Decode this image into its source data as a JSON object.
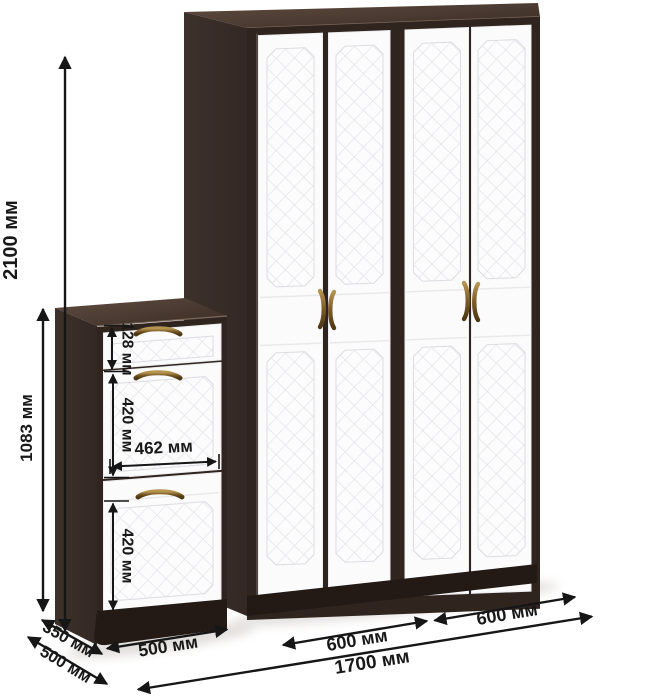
{
  "dimensions": {
    "wardrobe_height": "2100 мм",
    "cabinet_height": "1083 мм",
    "cabinet_drawer_height": "128 мм",
    "cabinet_upper_door_height": "420 мм",
    "cabinet_door_width": "462 мм",
    "cabinet_lower_door_height": "420 мм",
    "cabinet_top_depth": "350 мм",
    "cabinet_base_depth": "500 мм",
    "cabinet_width": "500 мм",
    "wardrobe_left_section_width": "600 мм",
    "wardrobe_right_section_width": "600 мм",
    "total_width": "1700 мм"
  },
  "colors": {
    "body_wenge": "#32271F",
    "door_white": "#FBFBFC",
    "quilt_line": "#E4E4E9",
    "handle_bronze": "#7A5B28",
    "dimension_ink": "#161616",
    "background": "#FFFFFF"
  }
}
